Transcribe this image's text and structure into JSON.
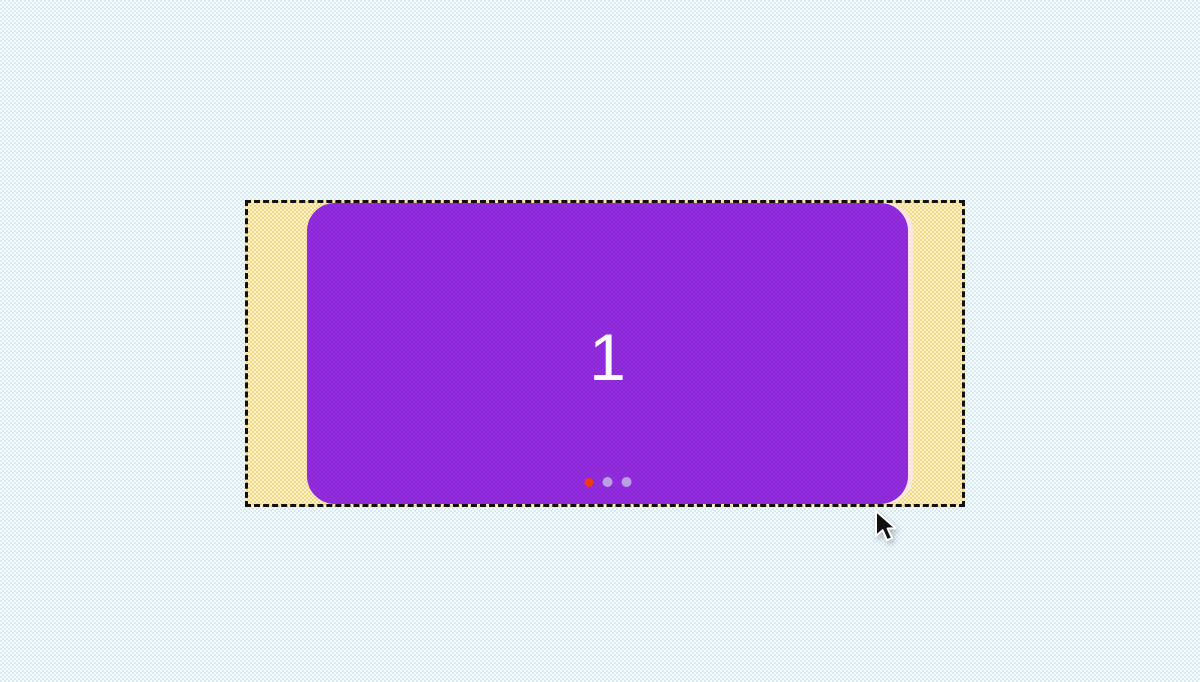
{
  "carousel": {
    "slide_label": "1",
    "dots": [
      {
        "state": "active",
        "color": "#ee3a14"
      },
      {
        "state": "inactive",
        "color": "#b9a0e2"
      },
      {
        "state": "inactive",
        "color": "#b9a0e2"
      }
    ]
  },
  "colors": {
    "page_bg_light": "#f7fbfd",
    "page_bg_dot": "#d8ebf3",
    "track_yellow": "#f3d885",
    "track_yellow_light": "#fdf2cc",
    "slide_purple_a": "#8226e3",
    "slide_purple_b": "#9a30cf",
    "next_edge_pink": "#fce6e3",
    "border_black": "#111111",
    "slide_text_white": "#fdfdfd",
    "dot_active_red": "#ee3a14",
    "dot_inactive_lavender": "#b9a0e2"
  }
}
